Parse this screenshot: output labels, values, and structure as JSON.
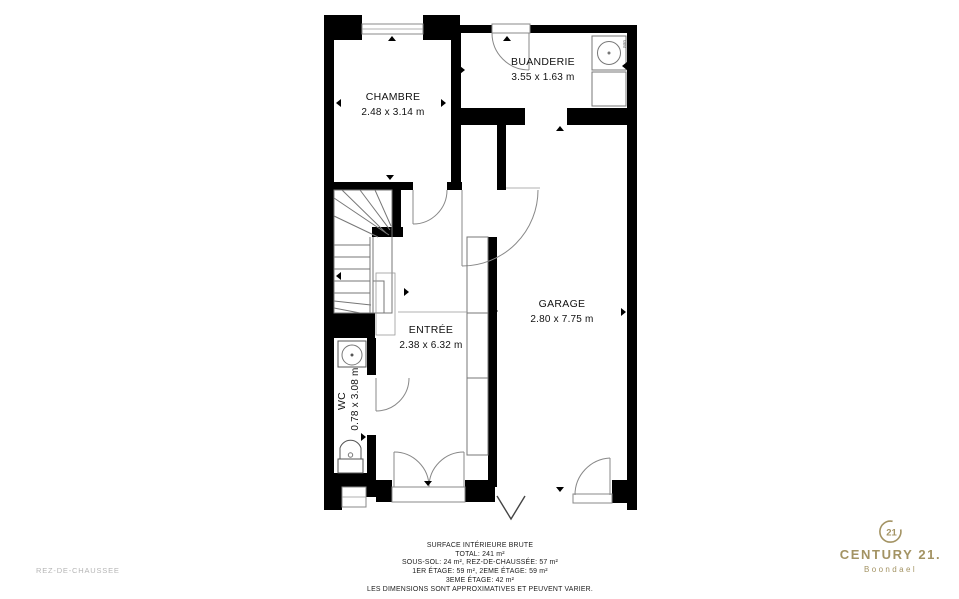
{
  "plan": {
    "rooms": [
      {
        "name": "CHAMBRE",
        "dims": "2.48 x 3.14 m"
      },
      {
        "name": "BUANDERIE",
        "dims": "3.55 x 1.63 m"
      },
      {
        "name": "ENTRÉE",
        "dims": "2.38 x 6.32 m"
      },
      {
        "name": "GARAGE",
        "dims": "2.80 x 7.75 m"
      },
      {
        "name": "WC",
        "dims": "0.78 x 3.08 m"
      }
    ],
    "appliances": {
      "washing_machine": "WM"
    }
  },
  "footer": {
    "floor_label": "REZ-DE-CHAUSSEE",
    "lines": [
      "SURFACE INTÉRIEURE BRUTE",
      "TOTAL: 241 m²",
      "SOUS-SOL: 24 m², REZ-DE-CHAUSSÉE: 57 m²",
      "1ER ÉTAGE: 59 m², 2EME ÉTAGE: 59 m²",
      "3EME ÉTAGE: 42 m²",
      "LES DIMENSIONS SONT APPROXIMATIVES ET PEUVENT VARIER."
    ]
  },
  "brand": {
    "seal_number": "21",
    "name": "CENTURY 21.",
    "agency": "Boondael",
    "color": "#A39363"
  }
}
